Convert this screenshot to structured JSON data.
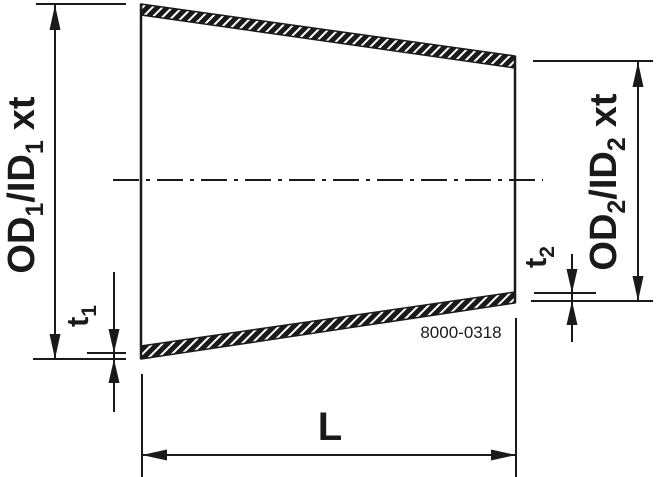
{
  "colors": {
    "ink": "#1a1a1a",
    "background": "#ffffff"
  },
  "labels": {
    "dim_left_outer": {
      "t1": "OD",
      "s1": "1",
      "t2": "/ID",
      "s2": "1",
      "t3": "xt"
    },
    "dim_right_outer": {
      "t1": "OD",
      "s1": "2",
      "t2": "/ID",
      "s2": "2",
      "t3": "xt"
    },
    "thickness_left": {
      "t": "t",
      "s": "1"
    },
    "thickness_right": {
      "t": "t",
      "s": "2"
    },
    "length": "L",
    "part_number": "8000-0318"
  }
}
